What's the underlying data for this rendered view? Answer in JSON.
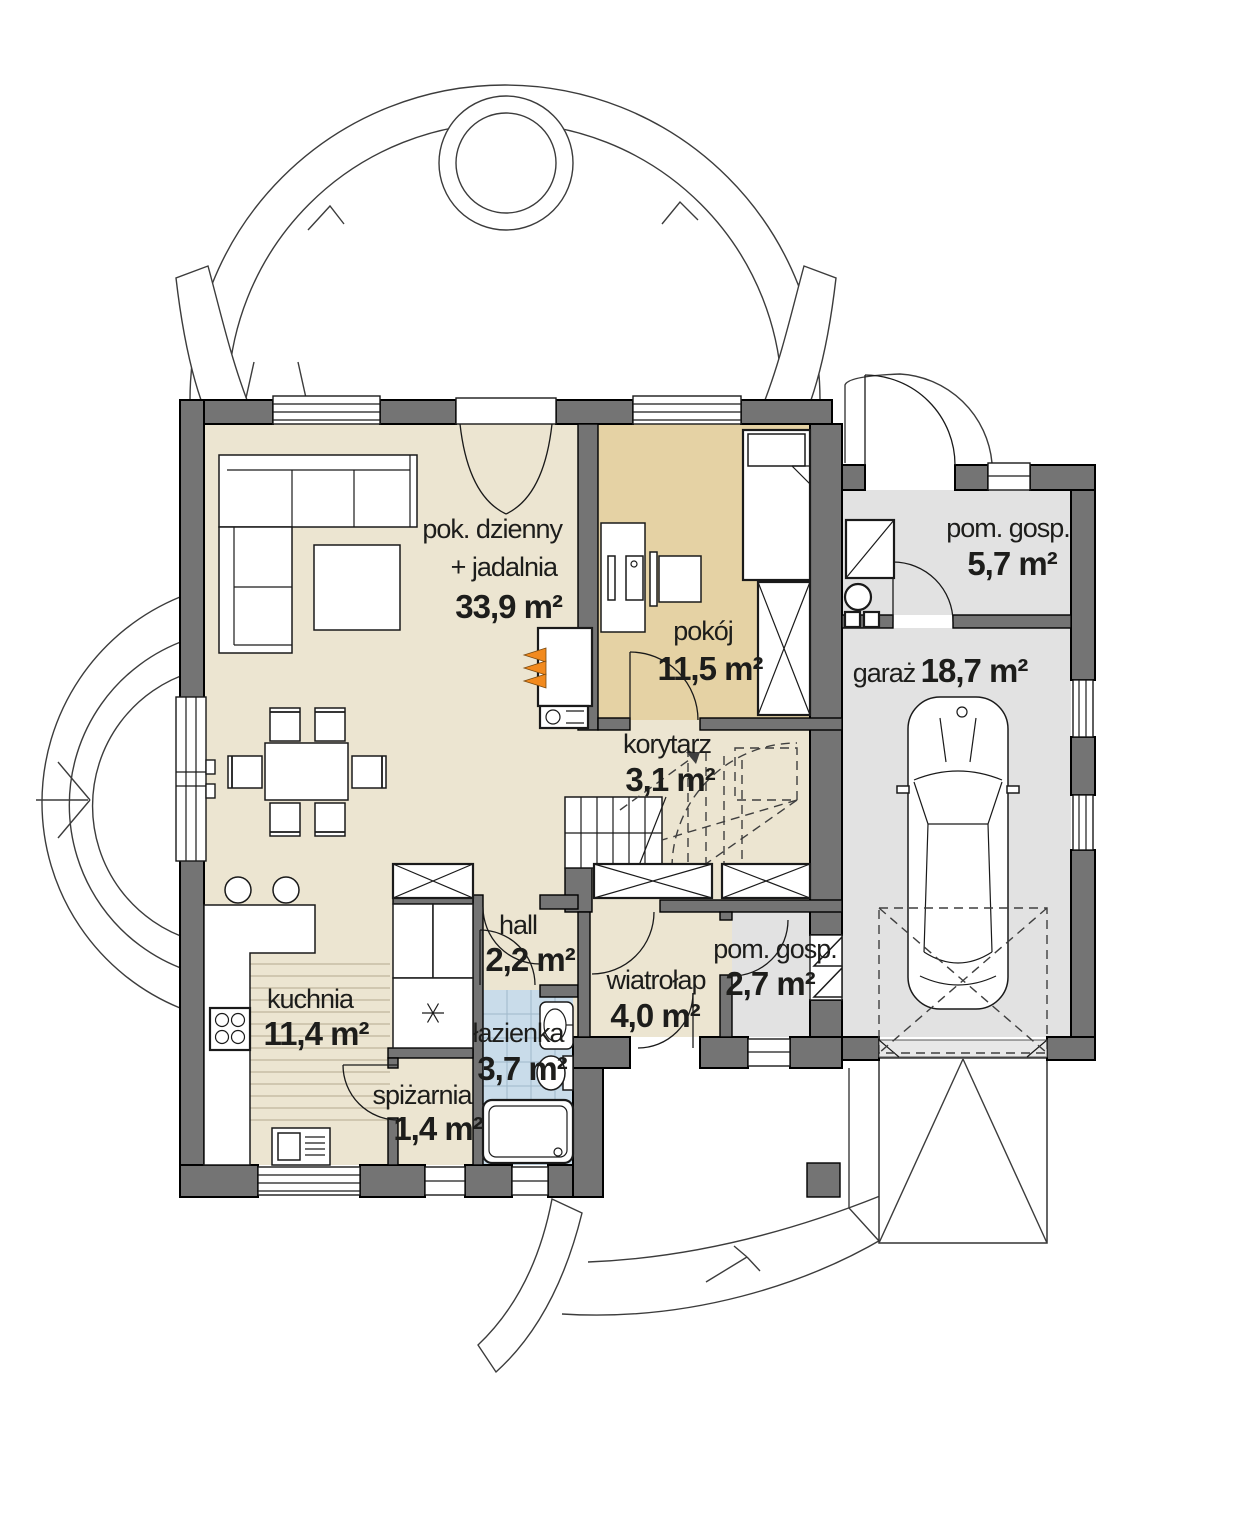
{
  "plan": {
    "type": "floor-plan-ground-floor",
    "rooms": {
      "living": {
        "name1": "pok. dzienny",
        "name2": "+ jadalnia",
        "area": "33,9 m²"
      },
      "pokoj": {
        "name": "pokój",
        "area": "11,5 m²"
      },
      "pom_gosp_gora": {
        "name": "pom. gosp.",
        "area": "5,7 m²"
      },
      "garaz": {
        "name": "garaż",
        "area": "18,7 m²"
      },
      "korytarz": {
        "name": "korytarz",
        "area": "3,1 m²"
      },
      "hall": {
        "name": "hall",
        "area": "2,2 m²"
      },
      "wiatrolap": {
        "name": "wiatrołap",
        "area": "4,0 m²"
      },
      "pom_gosp_dol": {
        "name": "pom. gosp.",
        "area": "2,7 m²"
      },
      "kuchnia": {
        "name": "kuchnia",
        "area": "11,4 m²"
      },
      "lazienka": {
        "name": "łazienka",
        "area": "3,7 m²"
      },
      "spizarnia": {
        "name": "spiżarnia",
        "area": "1,4 m²"
      }
    },
    "colors": {
      "wall": "#747474",
      "floor_main": "#ece5d1",
      "floor_room": "#e5d2a4",
      "floor_utility": "#e2e2e2",
      "floor_bath": "#c9dcea",
      "fireplace_accent": "#f28a1e"
    }
  }
}
